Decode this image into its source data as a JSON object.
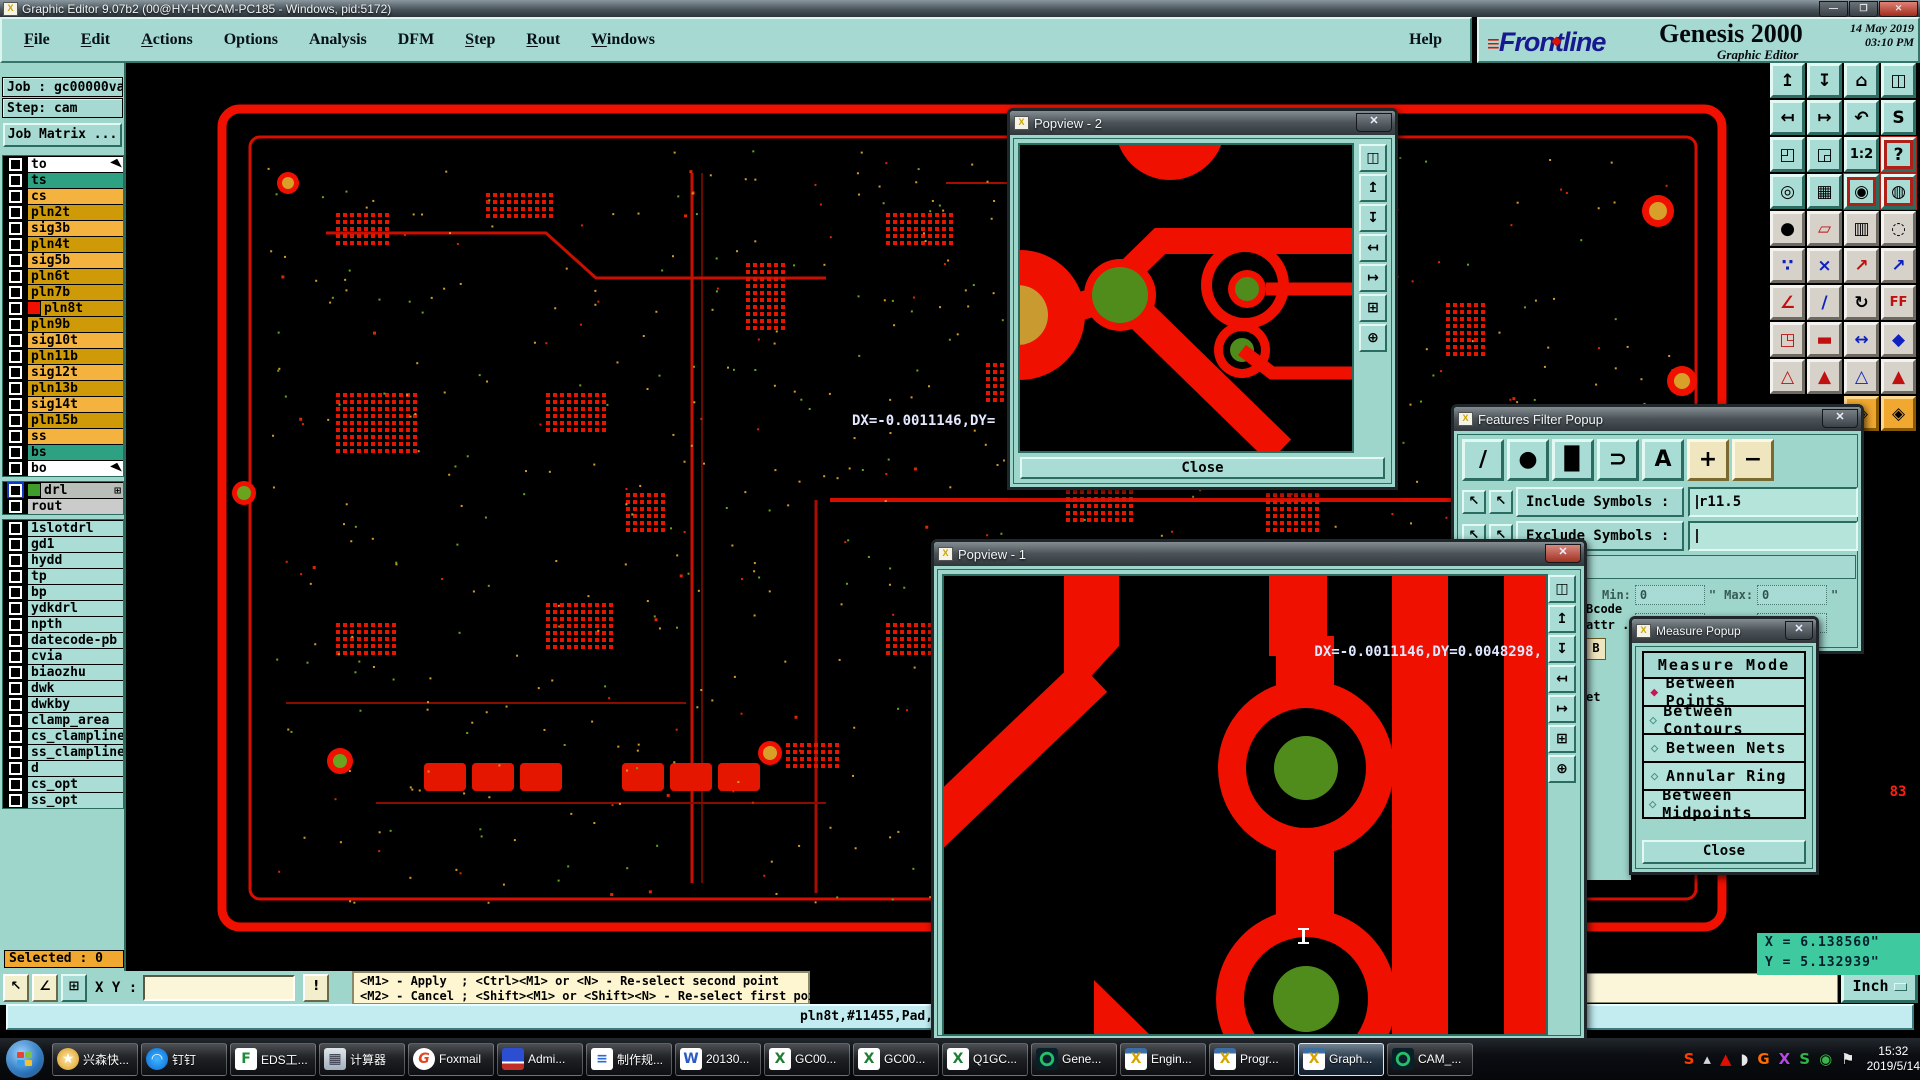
{
  "titlebar": {
    "title": "Graphic Editor 9.07b2 (00@HY-HYCAM-PC185 - Windows, pid:5172)",
    "icon_glyph": "X",
    "min": "—",
    "max": "❐",
    "close": "✕"
  },
  "menubar": {
    "items": [
      {
        "label": "File",
        "u": true
      },
      {
        "label": "Edit",
        "u": true
      },
      {
        "label": "Actions",
        "u": true
      },
      {
        "label": "Options",
        "u": false
      },
      {
        "label": "Analysis",
        "u": false
      },
      {
        "label": "DFM",
        "u": false
      },
      {
        "label": "Step",
        "u": true
      },
      {
        "label": "Rout",
        "u": true
      },
      {
        "label": "Windows",
        "u": true
      }
    ],
    "help": "Help"
  },
  "brand": {
    "marks": "≡",
    "logo": "Frontline",
    "product": "Genesis 2000",
    "subtitle": "Graphic Editor",
    "datetime": "14 May 2019\n 03:10 PM"
  },
  "job_panel": {
    "job": "Job : gc00000va0",
    "step": "Step: cam",
    "matrix": "Job Matrix ..."
  },
  "layers": {
    "group1": [
      {
        "name": "to",
        "style": "white",
        "arrow": true
      },
      {
        "name": "ts",
        "style": "teal"
      },
      {
        "name": "cs",
        "style": "orange"
      },
      {
        "name": "pln2t",
        "style": "gold"
      },
      {
        "name": "sig3b",
        "style": "orange"
      },
      {
        "name": "pln4t",
        "style": "gold"
      },
      {
        "name": "sig5b",
        "style": "orange"
      },
      {
        "name": "pln6t",
        "style": "gold"
      },
      {
        "name": "pln7b",
        "style": "gold"
      },
      {
        "name": "pln8t",
        "style": "gold",
        "active": true
      },
      {
        "name": "pln9b",
        "style": "gold"
      },
      {
        "name": "sig10t",
        "style": "orange"
      },
      {
        "name": "pln11b",
        "style": "gold"
      },
      {
        "name": "sig12t",
        "style": "orange"
      },
      {
        "name": "pln13b",
        "style": "gold"
      },
      {
        "name": "sig14t",
        "style": "orange"
      },
      {
        "name": "pln15b",
        "style": "gold"
      },
      {
        "name": "ss",
        "style": "orange"
      },
      {
        "name": "bs",
        "style": "teal"
      },
      {
        "name": "bo",
        "style": "white",
        "arrow": true
      }
    ],
    "group2": [
      {
        "name": "drl",
        "style": "gray",
        "chip": "#3f9e2a",
        "bluecheck": true,
        "plus": "⊞"
      },
      {
        "name": "rout",
        "style": "gray2"
      }
    ],
    "group3": [
      {
        "name": "1slotdrl",
        "style": "cyan"
      },
      {
        "name": "gd1",
        "style": "cyan"
      },
      {
        "name": "hydd",
        "style": "cyan"
      },
      {
        "name": "tp",
        "style": "cyan"
      },
      {
        "name": "bp",
        "style": "cyan"
      },
      {
        "name": "ydkdrl",
        "style": "cyan"
      },
      {
        "name": "npth",
        "style": "cyan"
      },
      {
        "name": "datecode-pb",
        "style": "cyan"
      },
      {
        "name": "cvia",
        "style": "cyan"
      },
      {
        "name": "biaozhu",
        "style": "cyan"
      },
      {
        "name": "dwk",
        "style": "cyan"
      },
      {
        "name": "dwkby",
        "style": "cyan"
      },
      {
        "name": "clamp_area",
        "style": "cyan"
      },
      {
        "name": "cs_clampline",
        "style": "cyan"
      },
      {
        "name": "ss_clampline",
        "style": "cyan"
      },
      {
        "name": "d",
        "style": "cyan"
      },
      {
        "name": "cs_opt",
        "style": "cyan"
      },
      {
        "name": "ss_opt",
        "style": "cyan"
      }
    ]
  },
  "toolbar": {
    "rows": [
      {
        "style": "t",
        "icons": [
          {
            "g": "↥",
            "n": "pan-up"
          },
          {
            "g": "↧",
            "n": "pan-down"
          },
          {
            "g": "⌂",
            "n": "home-view"
          },
          {
            "g": "◫",
            "n": "split-view-xy"
          }
        ]
      },
      {
        "style": "t",
        "icons": [
          {
            "g": "↤",
            "n": "pan-left"
          },
          {
            "g": "↦",
            "n": "pan-right"
          },
          {
            "g": "↶",
            "n": "previous-view"
          },
          {
            "g": "S",
            "n": "view-sequence"
          }
        ]
      },
      {
        "style": "t",
        "icons": [
          {
            "g": "◰",
            "n": "zoom-fit"
          },
          {
            "g": "◲",
            "n": "zoom-window"
          },
          {
            "g": "1:2",
            "n": "zoom-ratio"
          },
          {
            "g": "?",
            "n": "query-mode",
            "sel": true
          }
        ]
      },
      {
        "style": "t",
        "icons": [
          {
            "g": "◎",
            "n": "setup-tools"
          },
          {
            "g": "▦",
            "n": "grid-toggle"
          },
          {
            "g": "◉",
            "n": "layer-stoplight-1",
            "sel": true
          },
          {
            "g": "◍",
            "n": "layer-stoplight-2",
            "sel": true
          }
        ]
      },
      {
        "style": "g",
        "icons": [
          {
            "g": "●",
            "n": "move-feature"
          },
          {
            "g": "▱",
            "n": "transform-feature",
            "c": "#c01010"
          },
          {
            "g": "▥",
            "n": "measure-ruler"
          },
          {
            "g": "◌",
            "n": "select-area"
          }
        ]
      },
      {
        "style": "g",
        "icons": [
          {
            "g": "∵",
            "n": "net-points",
            "c": "#1020c0"
          },
          {
            "g": "×",
            "n": "delete-feature",
            "c": "#1020c0"
          },
          {
            "g": "↗",
            "n": "point-to-point",
            "c": "#c01010"
          },
          {
            "g": "↗",
            "n": "point-snap",
            "c": "#1020c0"
          }
        ]
      },
      {
        "style": "g",
        "icons": [
          {
            "g": "∠",
            "n": "angle-measure",
            "c": "#c01010"
          },
          {
            "g": "/",
            "n": "slope-line",
            "c": "#1020c0"
          },
          {
            "g": "↻",
            "n": "rotate-feature"
          },
          {
            "g": "FF",
            "n": "mirror-feature",
            "c": "#c01010"
          }
        ]
      },
      {
        "style": "g",
        "icons": [
          {
            "g": "◳",
            "n": "symbol-move",
            "c": "#c01010"
          },
          {
            "g": "▬",
            "n": "line-width",
            "c": "#c01010"
          },
          {
            "g": "↔",
            "n": "spacing-measure",
            "c": "#1020c0"
          },
          {
            "g": "◆",
            "n": "shapes-tool",
            "c": "#1020c0"
          }
        ]
      },
      {
        "style": "g",
        "icons": [
          {
            "g": "△",
            "n": "profile-check",
            "c": "#c01010"
          },
          {
            "g": "▲",
            "n": "height-check",
            "c": "#c01010"
          },
          {
            "g": "△",
            "n": "peak-measure",
            "c": "#1020c0"
          },
          {
            "g": "▲",
            "n": "peak-arrow",
            "c": "#c01010"
          }
        ]
      },
      {
        "style": "o",
        "icons": [
          {
            "g": "",
            "n": "spacer",
            "hide": true
          },
          {
            "g": "",
            "n": "spacer",
            "hide": true
          },
          {
            "g": "◈",
            "n": "net-route-1"
          },
          {
            "g": "◈",
            "n": "net-route-2"
          }
        ]
      }
    ],
    "badge": "83"
  },
  "popview2": {
    "title": "Popview - 2",
    "close": "Close",
    "strip": [
      {
        "g": "◫",
        "n": "popout-icon"
      },
      {
        "g": "↥",
        "n": "pan-up-icon"
      },
      {
        "g": "↧",
        "n": "pan-down-icon"
      },
      {
        "g": "↤",
        "n": "pan-left-icon"
      },
      {
        "g": "↦",
        "n": "pan-right-icon"
      },
      {
        "g": "⊞",
        "n": "zoom-fit-icon"
      },
      {
        "g": "⊕",
        "n": "pan-center-icon"
      }
    ]
  },
  "popview1": {
    "title": "Popview - 1",
    "dx_readout": "DX=-0.0011146,DY=0.0048298,",
    "strip": [
      {
        "g": "◫",
        "n": "popout-icon"
      },
      {
        "g": "↥",
        "n": "pan-up-icon"
      },
      {
        "g": "↧",
        "n": "pan-down-icon"
      },
      {
        "g": "↤",
        "n": "pan-left-icon"
      },
      {
        "g": "↦",
        "n": "pan-right-icon"
      },
      {
        "g": "⊞",
        "n": "zoom-fit-icon"
      },
      {
        "g": "⊕",
        "n": "pan-center-icon"
      }
    ]
  },
  "canvas": {
    "dx_readout": "DX=-0.0011146,DY="
  },
  "features_filter": {
    "title": "Features Filter Popup",
    "tools": [
      {
        "g": "∕",
        "n": "filter-lines-icon"
      },
      {
        "g": "●",
        "n": "filter-pads-icon"
      },
      {
        "g": "▉",
        "n": "filter-surfaces-icon"
      },
      {
        "g": "⊃",
        "n": "filter-arcs-icon"
      },
      {
        "g": "A",
        "n": "filter-text-icon"
      }
    ],
    "plus": "+",
    "minus": "−",
    "include_label": "Include Symbols :",
    "include_value": "r11.5",
    "exclude_label": "Exclude Symbols :",
    "exclude_value": "",
    "min_label": "Min:",
    "max_label": "Max:",
    "min1": "0",
    "max1": "0",
    "min2": "0",
    "max2": "0",
    "unit_mark": "\""
  },
  "fragments": {
    "texts": [
      "Bcode",
      "attr ."
    ],
    "button": "B",
    "text2": "et"
  },
  "measure_popup": {
    "title": "Measure Popup",
    "header": "Measure Mode",
    "options": [
      {
        "label": "Between Points",
        "selected": true
      },
      {
        "label": "Between Contours",
        "selected": false
      },
      {
        "label": "Between Nets",
        "selected": false
      },
      {
        "label": "Annular Ring",
        "selected": false
      },
      {
        "label": "Between Midpoints",
        "selected": false
      }
    ],
    "close": "Close"
  },
  "bottom": {
    "selected": "Selected : 0",
    "btn1": "↖",
    "btn2": "∠",
    "btn3": "⊞",
    "xy_label": "X Y :",
    "xy_value": "",
    "bang": "!",
    "hint_line1": "<M1> - Apply  ; <Ctrl><M1> or <N> - Re-select second point",
    "hint_line2": "<M2> - Cancel ; <Shift><M1> or <Shift><N> - Re-select first point",
    "status_text": "pln8t,#11455,Pad,X=",
    "coord_x": "X = 6.138560\"",
    "coord_y": "Y = 5.132939\"",
    "unit": "Inch"
  },
  "taskbar": {
    "items": [
      {
        "label": "兴森快...",
        "icon": "shell-icon",
        "g": "★"
      },
      {
        "label": "钉钉",
        "icon": "dingtalk-icon",
        "g": "◠"
      },
      {
        "label": "EDS工...",
        "icon": "eds-icon",
        "g": "F"
      },
      {
        "label": "计算器",
        "icon": "calculator-icon",
        "g": "▦"
      },
      {
        "label": "Foxmail",
        "icon": "foxmail-icon",
        "g": "G"
      },
      {
        "label": "Admi...",
        "icon": "disk-icon",
        "g": ""
      },
      {
        "label": "制作规...",
        "icon": "doc-icon",
        "g": "≡"
      },
      {
        "label": "20130...",
        "icon": "word-icon",
        "g": "W"
      },
      {
        "label": "GC00...",
        "icon": "excel-icon",
        "g": "X"
      },
      {
        "label": "GC00...",
        "icon": "excel-icon",
        "g": "X"
      },
      {
        "label": "Q1GC...",
        "icon": "excel-icon",
        "g": "X"
      },
      {
        "label": "Gene...",
        "icon": "genesis-icon",
        "g": ""
      },
      {
        "label": "Engin...",
        "icon": "xwin-icon",
        "g": "X"
      },
      {
        "label": "Progr...",
        "icon": "xwin-icon",
        "g": "X"
      },
      {
        "label": "Graph...",
        "icon": "xwin-icon",
        "g": "X",
        "active": true
      },
      {
        "label": "CAM_...",
        "icon": "genesis-icon",
        "g": ""
      }
    ],
    "tray": [
      {
        "g": "S",
        "c": "#ff3c00",
        "n": "tray-sogou-icon"
      },
      {
        "g": "▴",
        "c": "#cfd8dc",
        "n": "tray-arrow-icon"
      },
      {
        "g": "▲",
        "c": "#e01000",
        "n": "tray-reader-icon"
      },
      {
        "g": "◗",
        "c": "#e8e8e8",
        "n": "tray-speaker-icon"
      },
      {
        "g": "G",
        "c": "#ff6a00",
        "n": "tray-foxmail-icon"
      },
      {
        "g": "X",
        "c": "#b44ae0",
        "n": "tray-x-app-icon"
      },
      {
        "g": "S",
        "c": "#2fb34a",
        "n": "tray-s-app-icon"
      },
      {
        "g": "◉",
        "c": "#3bb54a",
        "n": "tray-shield-icon"
      },
      {
        "g": "⚑",
        "c": "#e8e8e8",
        "n": "tray-flag-icon"
      }
    ],
    "time": "15:32",
    "date": "2019/5/14"
  }
}
